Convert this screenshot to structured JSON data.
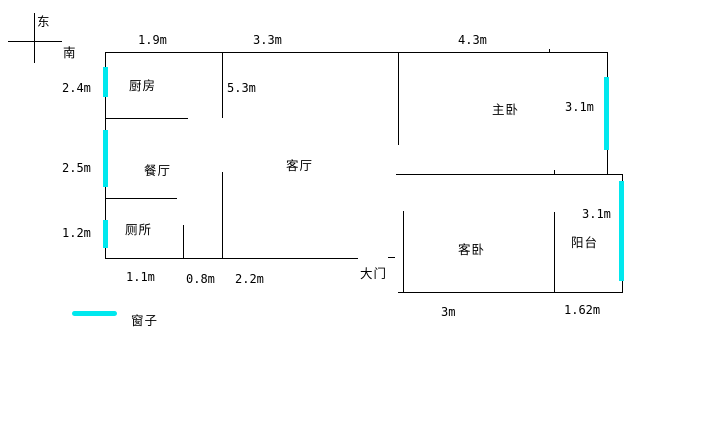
{
  "compass": {
    "east": "东",
    "south": "南"
  },
  "rooms": {
    "kitchen": "厨房",
    "dining": "餐厅",
    "toilet": "厕所",
    "living": "客厅",
    "master": "主卧",
    "guest": "客卧",
    "balcony": "阳台"
  },
  "door_label": "大门",
  "dims": {
    "top_kitchen": "1.9m",
    "top_living": "3.3m",
    "top_master": "4.3m",
    "left_kitchen": "2.4m",
    "left_dining": "2.5m",
    "left_toilet": "1.2m",
    "living_depth": "5.3m",
    "master_window": "3.1m",
    "balcony_window": "3.1m",
    "bottom_toilet": "1.1m",
    "bottom_toilet_door": "0.8m",
    "bottom_living": "2.2m",
    "guest_width": "3m",
    "balcony_width": "1.62m"
  },
  "legend": {
    "window": "窗子"
  },
  "colors": {
    "window": "#00e8ee",
    "wall": "#000000",
    "background": "#ffffff"
  }
}
